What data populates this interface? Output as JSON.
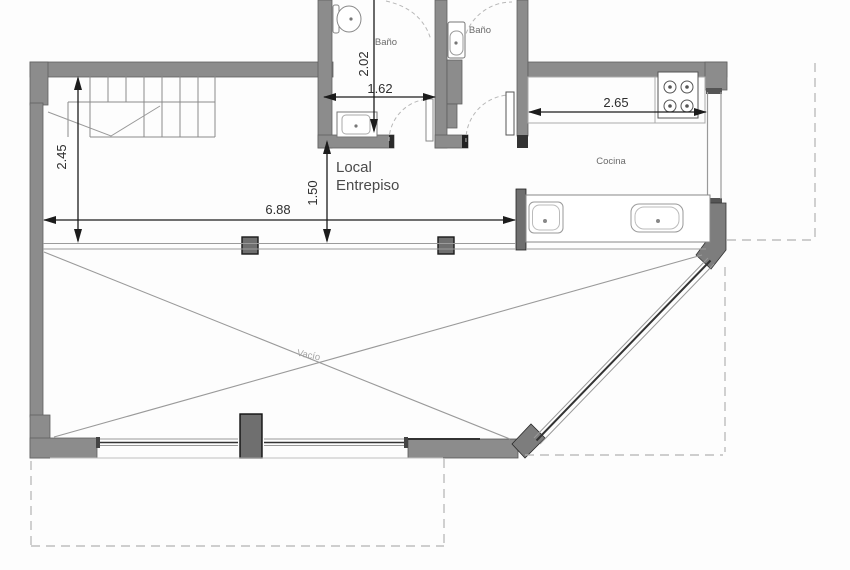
{
  "labels": {
    "bath1": "Baño",
    "bath2": "Baño",
    "mezzanine_line1": "Local",
    "mezzanine_line2": "Entrepiso",
    "kitchen": "Cocina",
    "void": "Vacío"
  },
  "dimensions": {
    "bath_depth": "2.02",
    "bath_width": "1.62",
    "stair_hall_depth": "2.45",
    "mezzanine_edge_depth": "1.50",
    "mezzanine_width": "6.88",
    "kitchen_width": "2.65"
  },
  "colors": {
    "wall_fill": "#8c8c8c",
    "wall_dark": "#2b2b2b",
    "thin_line": "#999999",
    "glazing_line": "#333333",
    "dashed_line": "#b3b3b3",
    "dimension_line": "#1c1c1c",
    "background": "#fdfdfd"
  }
}
